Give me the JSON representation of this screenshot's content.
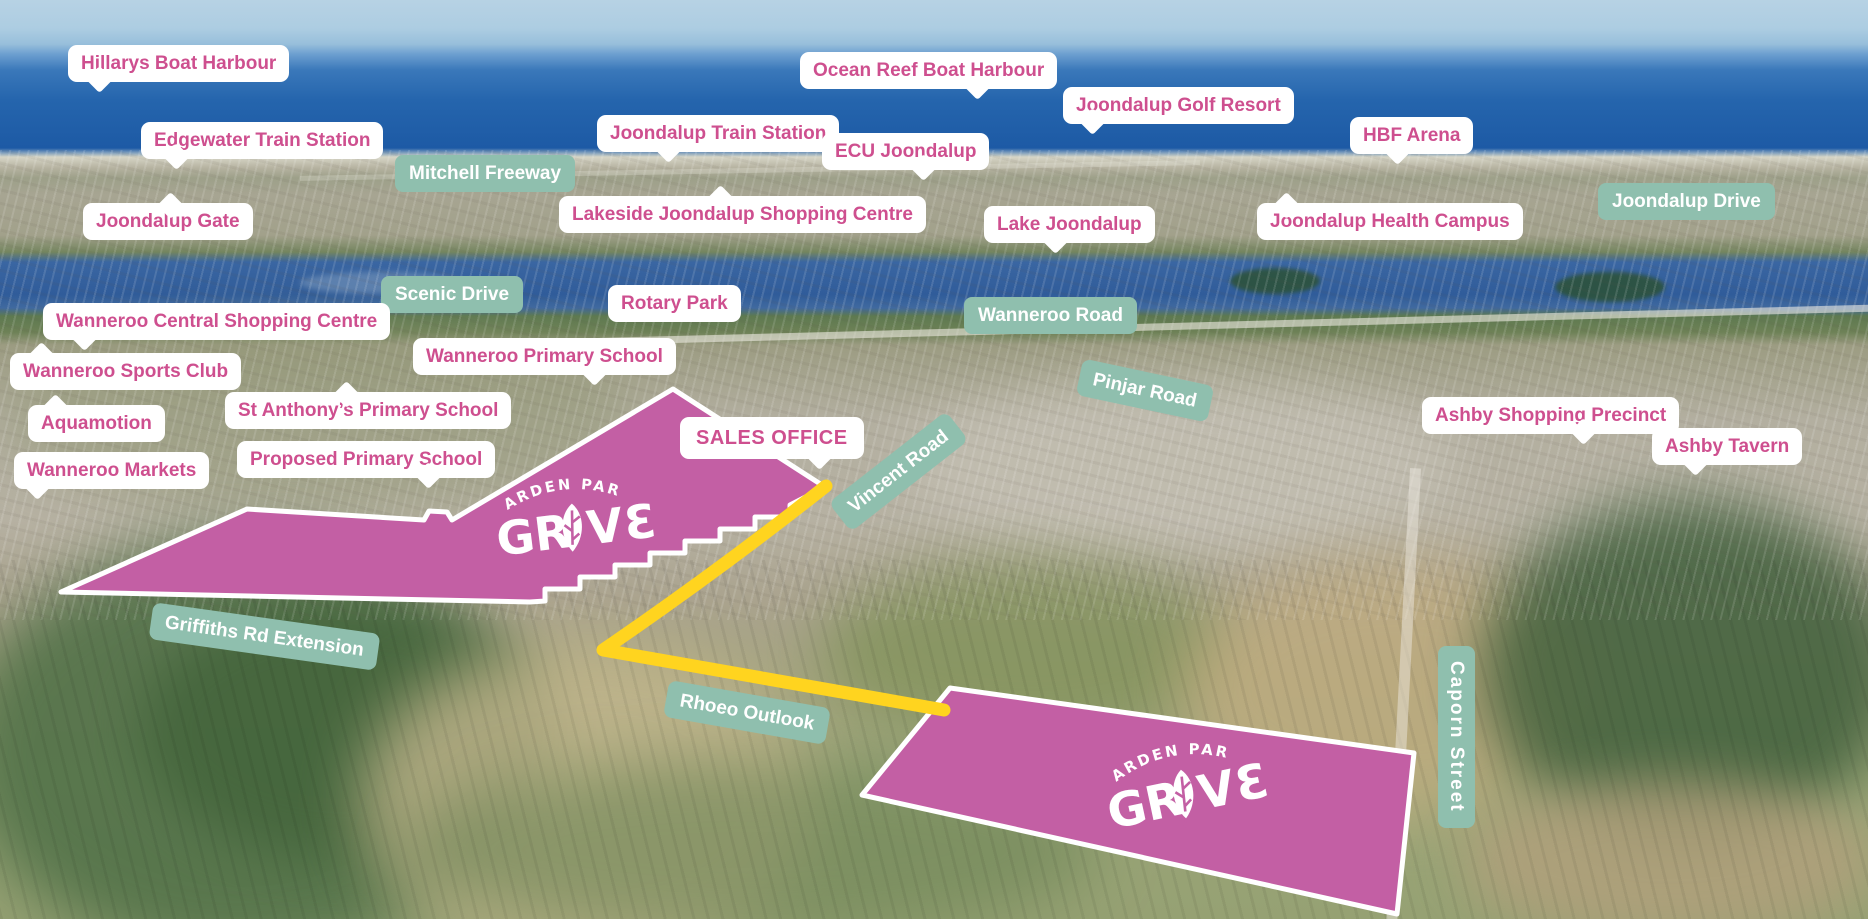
{
  "map": {
    "estate": {
      "brand_arc_text": "GARDEN PARK",
      "brand_word": "GROVE",
      "parcel_color": "#c35fa4",
      "highlight_road_color": "#ffd41f",
      "road_label_color": "#8fbfae",
      "landmark_text_color": "#ce4f8f"
    },
    "landmarks": [
      {
        "id": "hillarys-boat-harbour",
        "text": "Hillarys Boat Harbour",
        "x": 68,
        "y": 45,
        "tail": "b",
        "tailx": 22
      },
      {
        "id": "edgewater-train-station",
        "text": "Edgewater Train Station",
        "x": 141,
        "y": 122,
        "tail": "b",
        "tailx": 26
      },
      {
        "id": "joondalup-gate",
        "text": "Joondalup Gate",
        "x": 83,
        "y": 203,
        "tail": "t",
        "tailx": 78
      },
      {
        "id": "joondalup-train-station",
        "text": "Joondalup Train Station",
        "x": 597,
        "y": 115,
        "tail": "b",
        "tailx": 62
      },
      {
        "id": "ocean-reef-boat-harbour",
        "text": "Ocean Reef Boat Harbour",
        "x": 800,
        "y": 52,
        "tail": "b",
        "tailx": 168
      },
      {
        "id": "ecu-joondalup",
        "text": "ECU Joondalup",
        "x": 822,
        "y": 133,
        "tail": "b",
        "tailx": 92
      },
      {
        "id": "joondalup-golf-resort",
        "text": "Joondalup Golf Resort",
        "x": 1063,
        "y": 87,
        "tail": "b",
        "tailx": 20
      },
      {
        "id": "hbf-arena",
        "text": "HBF Arena",
        "x": 1350,
        "y": 117,
        "tail": "b",
        "tailx": 38
      },
      {
        "id": "lakeside-joondalup-shopping-centre",
        "text": "Lakeside Joondalup Shopping Centre",
        "x": 559,
        "y": 196,
        "tail": "t",
        "tailx": 152
      },
      {
        "id": "lake-joondalup",
        "text": "Lake Joondalup",
        "x": 984,
        "y": 206,
        "tail": "b",
        "tailx": 62
      },
      {
        "id": "joondalup-health-campus",
        "text": "Joondalup Health Campus",
        "x": 1257,
        "y": 203,
        "tail": "t",
        "tailx": 20
      },
      {
        "id": "rotary-park",
        "text": "Rotary Park",
        "x": 608,
        "y": 285,
        "tail": null,
        "tailx": 0
      },
      {
        "id": "wanneroo-central-shopping-centre",
        "text": "Wanneroo Central Shopping Centre",
        "x": 43,
        "y": 303,
        "tail": "b",
        "tailx": 32
      },
      {
        "id": "wanneroo-sports-club",
        "text": "Wanneroo Sports Club",
        "x": 10,
        "y": 353,
        "tail": "t",
        "tailx": 22
      },
      {
        "id": "aquamotion",
        "text": "Aquamotion",
        "x": 28,
        "y": 405,
        "tail": "t",
        "tailx": 18
      },
      {
        "id": "wanneroo-markets",
        "text": "Wanneroo Markets",
        "x": 14,
        "y": 452,
        "tail": "b",
        "tailx": 14
      },
      {
        "id": "st-anthonys-primary-school",
        "text": "St Anthony’s Primary School",
        "x": 225,
        "y": 392,
        "tail": "t",
        "tailx": 112
      },
      {
        "id": "wanneroo-primary-school",
        "text": "Wanneroo Primary School",
        "x": 413,
        "y": 338,
        "tail": "b",
        "tailx": 172
      },
      {
        "id": "proposed-primary-school",
        "text": "Proposed Primary School",
        "x": 237,
        "y": 441,
        "tail": "b",
        "tailx": 182
      },
      {
        "id": "ashby-shopping-precinct",
        "text": "Ashby Shopping Precinct",
        "x": 1422,
        "y": 397,
        "tail": "b",
        "tailx": 152
      },
      {
        "id": "ashby-tavern",
        "text": "Ashby Tavern",
        "x": 1652,
        "y": 428,
        "tail": "b",
        "tailx": 34
      },
      {
        "id": "sales-office",
        "text": "SALES OFFICE",
        "x": 680,
        "y": 417,
        "tail": "b",
        "tailx": 130,
        "variant": "sales"
      }
    ],
    "road_labels": [
      {
        "id": "mitchell-freeway",
        "text": "Mitchell Freeway",
        "x": 395,
        "y": 155,
        "rot": 0,
        "vertical": false
      },
      {
        "id": "joondalup-drive",
        "text": "Joondalup Drive",
        "x": 1598,
        "y": 183,
        "rot": 0,
        "vertical": false
      },
      {
        "id": "scenic-drive",
        "text": "Scenic Drive",
        "x": 381,
        "y": 276,
        "rot": 0,
        "vertical": false
      },
      {
        "id": "wanneroo-road",
        "text": "Wanneroo Road",
        "x": 964,
        "y": 297,
        "rot": 0,
        "vertical": false
      },
      {
        "id": "pinjar-road",
        "text": "Pinjar Road",
        "x": 1078,
        "y": 372,
        "rot": 12,
        "vertical": false
      },
      {
        "id": "vincent-road",
        "text": "Vincent Road",
        "x": 824,
        "y": 453,
        "rot": -38,
        "vertical": false
      },
      {
        "id": "griffiths-rd-extension",
        "text": "Griffiths Rd Extension",
        "x": 150,
        "y": 618,
        "rot": 8,
        "vertical": false
      },
      {
        "id": "rhoeo-outlook",
        "text": "Rhoeo Outlook",
        "x": 665,
        "y": 694,
        "rot": 10,
        "vertical": false
      },
      {
        "id": "caporn-street",
        "text": "Caporn Street",
        "x": 1438,
        "y": 646,
        "rot": 0,
        "vertical": true
      }
    ]
  }
}
